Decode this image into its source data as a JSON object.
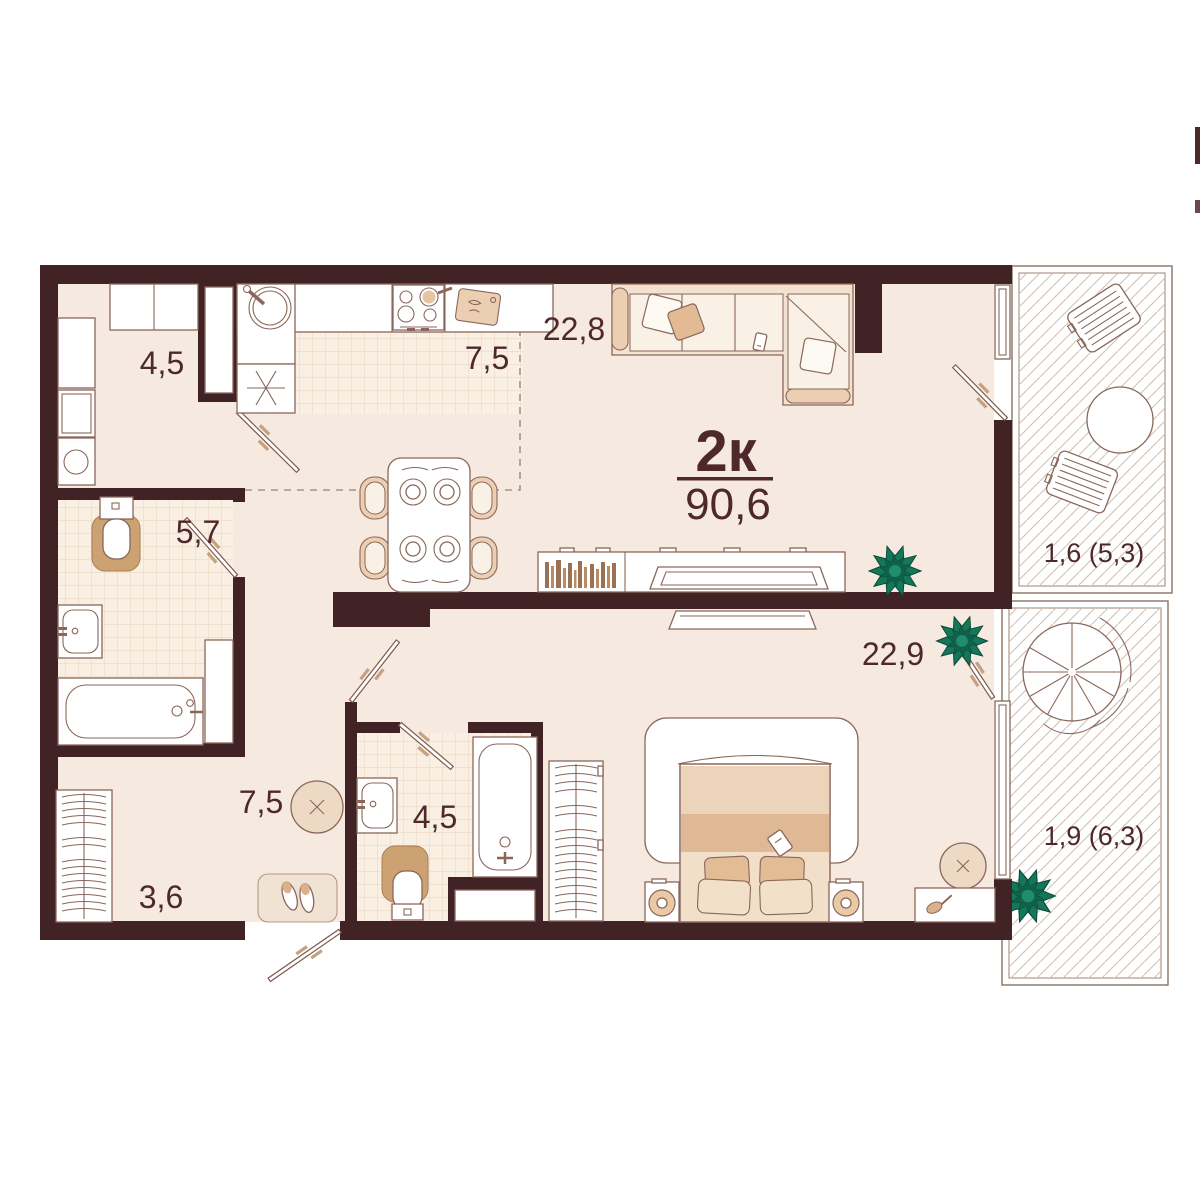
{
  "plan": {
    "type_label": "2к",
    "total_area": "90,6",
    "rooms": {
      "laundry": "4,5",
      "kitchen": "7,5",
      "living_room": "22,8",
      "bathroom_main": "5,7",
      "hallway": "7,5",
      "bathroom_second": "4,5",
      "wardrobe": "3,6",
      "bedroom": "22,9",
      "balcony_upper": "1,6 (5,3)",
      "balcony_lower": "1,9 (6,3)"
    },
    "colors": {
      "wall": "#412225",
      "label_text": "#4e282b",
      "floor": "#f6e9e0",
      "tile": "#f9efe3",
      "furniture_outline": "#8a675a",
      "wood_beige": "#eccfb2",
      "plant_green": "#15775a",
      "balcony_hatch": "#d2c1b1"
    }
  }
}
